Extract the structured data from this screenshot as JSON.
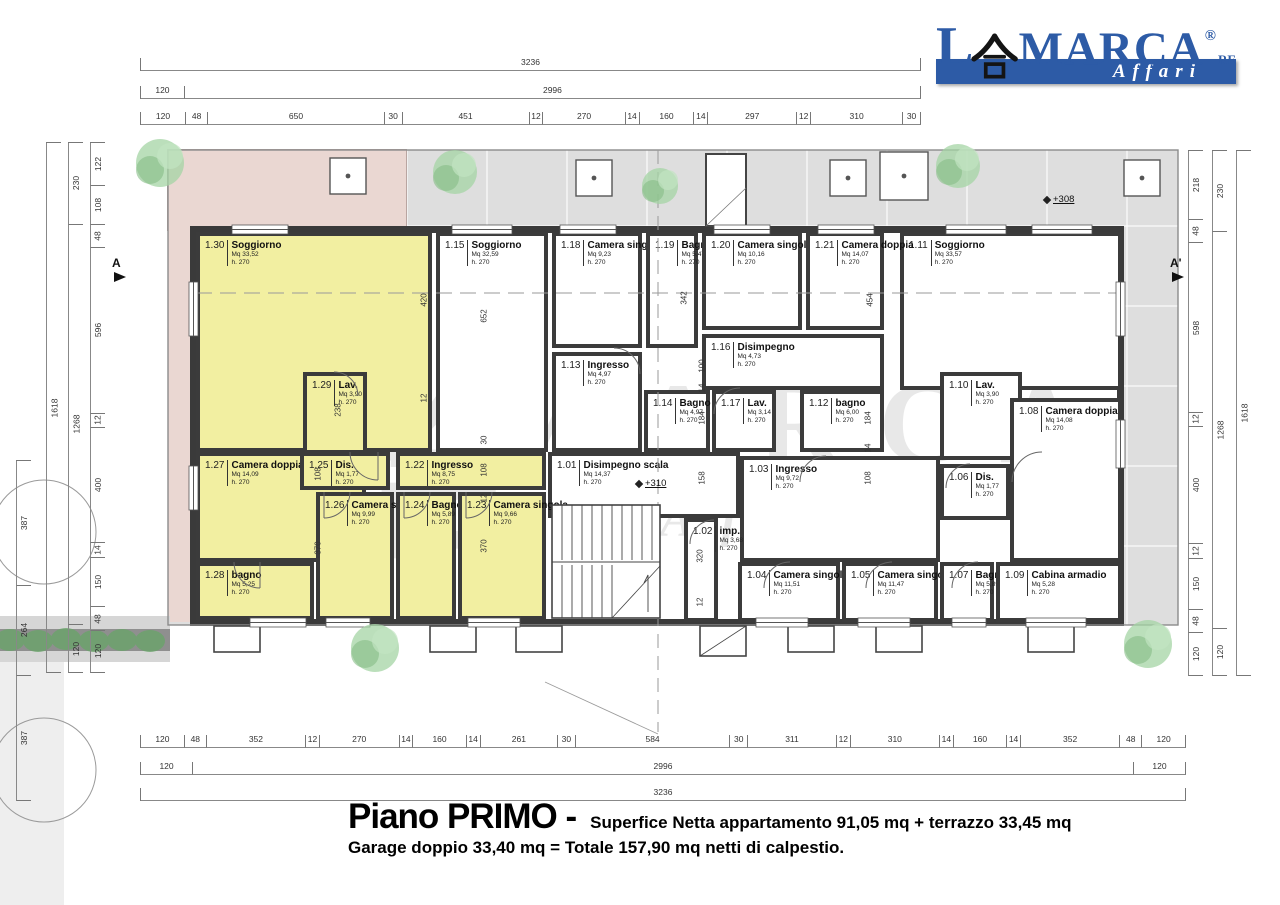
{
  "logo": {
    "l": "L",
    "kanji": "合",
    "marca": "MARCA",
    "reg": "®",
    "re": "RE",
    "tagline": "Affari"
  },
  "title": {
    "main": "Piano PRIMO -",
    "sub1": "Superfice Netta appartamento 91,05 mq + terrazzo 33,45 mq",
    "sub2": "Garage doppio 33,40 mq = Totale 157,90 mq netti di calpestio."
  },
  "markers": {
    "section_a": "A",
    "section_a2": "A'",
    "level_stairs": "+310",
    "level_terrace": "+308"
  },
  "colors": {
    "apartment_highlight": "#f2efa1",
    "terrace_pink": "#ead7d2",
    "platform_gray": "#dedede",
    "logo_blue": "#2d5ba6",
    "wall": "#3a3a3a"
  },
  "rooms": [
    {
      "n": "1.30",
      "name": "Soggiorno",
      "mq": "Mq 33,52",
      "h": "h. 270",
      "px": 196,
      "py": 232,
      "pw": 236,
      "ph": 220,
      "cls": "yellow"
    },
    {
      "n": "1.15",
      "name": "Soggiorno",
      "mq": "Mq 32,59",
      "h": "h. 270",
      "px": 436,
      "py": 232,
      "pw": 112,
      "ph": 220,
      "cls": "white"
    },
    {
      "n": "1.11",
      "name": "Soggiorno",
      "mq": "Mq 33,57",
      "h": "h. 270",
      "px": 900,
      "py": 232,
      "pw": 222,
      "ph": 158,
      "cls": "white"
    },
    {
      "n": "1.18",
      "name": "Camera singola",
      "mq": "Mq 9,23",
      "h": "h. 270",
      "px": 552,
      "py": 232,
      "pw": 90,
      "ph": 116,
      "cls": "white"
    },
    {
      "n": "1.19",
      "name": "Bagno",
      "mq": "Mq 5,47",
      "h": "h. 270",
      "px": 646,
      "py": 232,
      "pw": 52,
      "ph": 116,
      "cls": "white"
    },
    {
      "n": "1.20",
      "name": "Camera singola",
      "mq": "Mq 10,16",
      "h": "h. 270",
      "px": 702,
      "py": 232,
      "pw": 100,
      "ph": 98,
      "cls": "white"
    },
    {
      "n": "1.21",
      "name": "Camera doppia",
      "mq": "Mq 14,07",
      "h": "h. 270",
      "px": 806,
      "py": 232,
      "pw": 78,
      "ph": 98,
      "cls": "white"
    },
    {
      "n": "1.13",
      "name": "Ingresso",
      "mq": "Mq 4,97",
      "h": "h. 270",
      "px": 552,
      "py": 352,
      "pw": 90,
      "ph": 100,
      "cls": "white"
    },
    {
      "n": "1.16",
      "name": "Disimpegno",
      "mq": "Mq 4,73",
      "h": "h. 270",
      "px": 702,
      "py": 334,
      "pw": 182,
      "ph": 56,
      "cls": "white"
    },
    {
      "n": "1.27",
      "name": "Camera doppia",
      "mq": "Mq 14,09",
      "h": "h. 270",
      "px": 196,
      "py": 452,
      "pw": 170,
      "ph": 110,
      "cls": "yellow"
    },
    {
      "n": "1.14",
      "name": "Bagno",
      "mq": "Mq 4,97",
      "h": "h. 270",
      "px": 644,
      "py": 390,
      "pw": 66,
      "ph": 62,
      "cls": "white"
    },
    {
      "n": "1.17",
      "name": "Lav.",
      "mq": "Mq 3,14",
      "h": "h. 270",
      "px": 712,
      "py": 390,
      "pw": 64,
      "ph": 62,
      "cls": "white"
    },
    {
      "n": "1.12",
      "name": "bagno",
      "mq": "Mq 6,00",
      "h": "h. 270",
      "px": 800,
      "py": 390,
      "pw": 84,
      "ph": 62,
      "cls": "white"
    },
    {
      "n": "1.10",
      "name": "Lav.",
      "mq": "Mq 3,90",
      "h": "h. 270",
      "px": 940,
      "py": 372,
      "pw": 82,
      "ph": 88,
      "cls": "white"
    },
    {
      "n": "1.08",
      "name": "Camera doppia",
      "mq": "Mq 14,08",
      "h": "h. 270",
      "px": 1010,
      "py": 398,
      "pw": 112,
      "ph": 164,
      "cls": "white"
    },
    {
      "n": "1.03",
      "name": "Ingresso",
      "mq": "Mq 9,72",
      "h": "h. 270",
      "px": 740,
      "py": 456,
      "pw": 200,
      "ph": 106,
      "cls": "white"
    },
    {
      "n": "1.01",
      "name": "Disimpegno scala",
      "mq": "Mq 14,37",
      "h": "h. 270",
      "px": 548,
      "py": 452,
      "pw": 192,
      "ph": 66,
      "cls": "white"
    },
    {
      "n": "1.28",
      "name": "bagno",
      "mq": "Mq 5,25",
      "h": "h. 270",
      "px": 196,
      "py": 562,
      "pw": 118,
      "ph": 58,
      "cls": "yellow"
    },
    {
      "n": "1.26",
      "name": "Camera singola",
      "mq": "Mq 9,99",
      "h": "h. 270",
      "px": 316,
      "py": 492,
      "pw": 78,
      "ph": 128,
      "cls": "yellow"
    },
    {
      "n": "1.24",
      "name": "Bagno",
      "mq": "Mq 5,89",
      "h": "h. 270",
      "px": 396,
      "py": 492,
      "pw": 60,
      "ph": 128,
      "cls": "yellow"
    },
    {
      "n": "1.23",
      "name": "Camera singola",
      "mq": "Mq 9,66",
      "h": "h. 270",
      "px": 458,
      "py": 492,
      "pw": 88,
      "ph": 128,
      "cls": "yellow"
    },
    {
      "n": "1.22",
      "name": "Ingresso",
      "mq": "Mq 8,75",
      "h": "h. 270",
      "px": 396,
      "py": 452,
      "pw": 150,
      "ph": 38,
      "cls": "yellow"
    },
    {
      "n": "1.25",
      "name": "Dis.",
      "mq": "Mq 1,77",
      "h": "h. 270",
      "px": 300,
      "py": 452,
      "pw": 90,
      "ph": 38,
      "cls": "yellow"
    },
    {
      "n": "1.29",
      "name": "Lav.",
      "mq": "Mq 3,90",
      "h": "h. 270",
      "px": 303,
      "py": 372,
      "pw": 64,
      "ph": 82,
      "cls": "yellow"
    },
    {
      "n": "1.06",
      "name": "Dis.",
      "mq": "Mq 1,77",
      "h": "h. 270",
      "px": 940,
      "py": 464,
      "pw": 70,
      "ph": 56,
      "cls": "white"
    },
    {
      "n": "1.02",
      "name": "imp.",
      "mq": "Mq 3,68",
      "h": "h. 270",
      "px": 684,
      "py": 518,
      "pw": 34,
      "ph": 104,
      "cls": "white"
    },
    {
      "n": "1.04",
      "name": "Camera singola",
      "mq": "Mq 11,51",
      "h": "h. 270",
      "px": 738,
      "py": 562,
      "pw": 102,
      "ph": 60,
      "cls": "white"
    },
    {
      "n": "1.05",
      "name": "Camera singola",
      "mq": "Mq 11,47",
      "h": "h. 270",
      "px": 842,
      "py": 562,
      "pw": 96,
      "ph": 60,
      "cls": "white"
    },
    {
      "n": "1.07",
      "name": "Bagno",
      "mq": "Mq 5,89",
      "h": "h. 270",
      "px": 940,
      "py": 562,
      "pw": 54,
      "ph": 60,
      "cls": "white"
    },
    {
      "n": "1.09",
      "name": "Cabina armadio",
      "mq": "Mq 5,28",
      "h": "h. 270",
      "px": 996,
      "py": 562,
      "pw": 126,
      "ph": 60,
      "cls": "white"
    }
  ],
  "dims": {
    "top1": [
      "3236"
    ],
    "top2": [
      "120",
      "2996"
    ],
    "top3": [
      "120",
      "48",
      "650",
      "30",
      "451",
      "12",
      "270",
      "14",
      "160",
      "14",
      "297",
      "12",
      "310",
      "30"
    ],
    "bot1": [
      "120",
      "48",
      "352",
      "12",
      "270",
      "14",
      "160",
      "14",
      "261",
      "30",
      "584",
      "30",
      "311",
      "12",
      "310",
      "14",
      "160",
      "14",
      "352",
      "48",
      "120"
    ],
    "bot2": [
      "120",
      "2996",
      "120"
    ],
    "bot3": [
      "3236"
    ],
    "farleft": [
      "387",
      "264",
      "387"
    ],
    "left1": [
      "1618"
    ],
    "left2": [
      "230",
      "1268",
      "120"
    ],
    "left3": [
      "122",
      "108",
      "48",
      "596",
      "12",
      "400",
      "14",
      "150",
      "48",
      "120"
    ],
    "right3": [
      "218",
      "48",
      "598",
      "12",
      "400",
      "12",
      "150",
      "48",
      "120"
    ],
    "right2": [
      "230",
      "1268",
      "120"
    ],
    "right1": [
      "1618"
    ]
  },
  "interior_dims": [
    {
      "t": "420",
      "px": 424,
      "py": 300
    },
    {
      "t": "12",
      "px": 424,
      "py": 398
    },
    {
      "t": "238",
      "px": 338,
      "py": 410
    },
    {
      "t": "652",
      "px": 484,
      "py": 316
    },
    {
      "t": "30",
      "px": 484,
      "py": 440
    },
    {
      "t": "108",
      "px": 484,
      "py": 470
    },
    {
      "t": "12",
      "px": 484,
      "py": 498
    },
    {
      "t": "370",
      "px": 484,
      "py": 546
    },
    {
      "t": "370",
      "px": 318,
      "py": 548
    },
    {
      "t": "108",
      "px": 318,
      "py": 474
    },
    {
      "t": "342",
      "px": 684,
      "py": 298
    },
    {
      "t": "100",
      "px": 702,
      "py": 366
    },
    {
      "t": "14",
      "px": 702,
      "py": 388
    },
    {
      "t": "184",
      "px": 702,
      "py": 418
    },
    {
      "t": "454",
      "px": 870,
      "py": 300
    },
    {
      "t": "184",
      "px": 868,
      "py": 418
    },
    {
      "t": "14",
      "px": 868,
      "py": 448
    },
    {
      "t": "108",
      "px": 868,
      "py": 478
    },
    {
      "t": "158",
      "px": 702,
      "py": 478
    },
    {
      "t": "320",
      "px": 700,
      "py": 556
    },
    {
      "t": "12",
      "px": 700,
      "py": 602
    }
  ]
}
